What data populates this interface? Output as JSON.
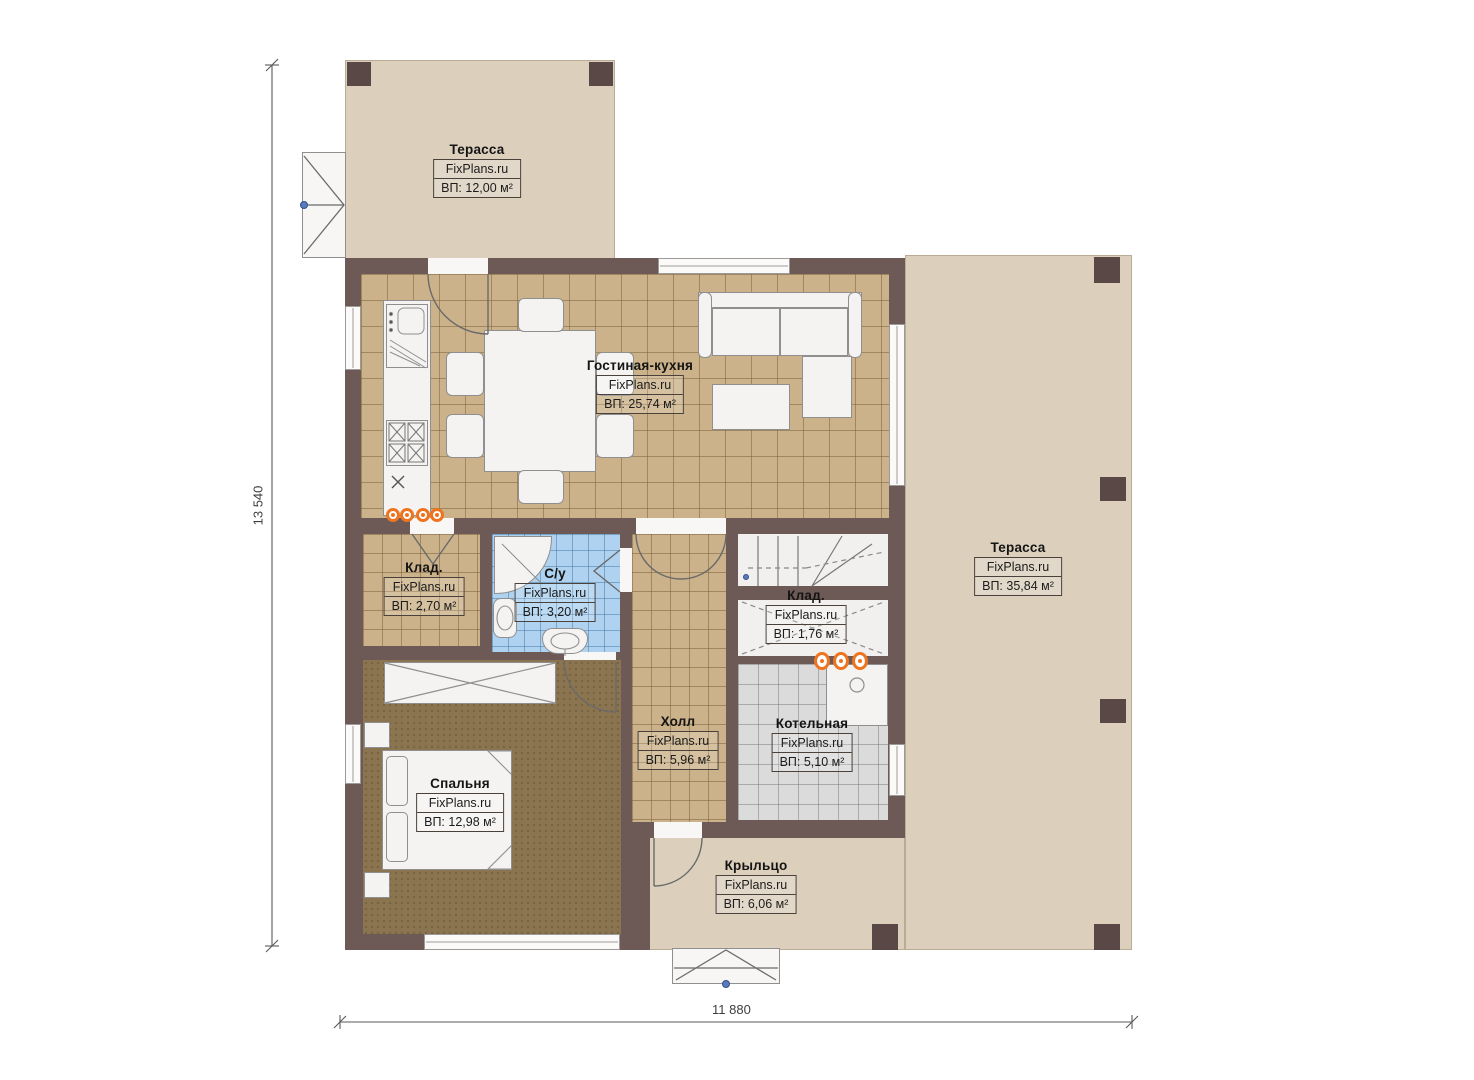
{
  "brand": "FixPlans.ru",
  "dimensions": {
    "left": "13 540",
    "bottom": "11 880"
  },
  "rooms": {
    "terrace_top": {
      "name": "Терасса",
      "area": "ВП: 12,00 м²"
    },
    "living_kitchen": {
      "name": "Гостиная-кухня",
      "area": "ВП: 25,74 м²"
    },
    "terrace_right": {
      "name": "Терасса",
      "area": "ВП: 35,84 м²"
    },
    "storage_left": {
      "name": "Клад.",
      "area": "ВП: 2,70 м²"
    },
    "bathroom": {
      "name": "С/у",
      "area": "ВП: 3,20 м²"
    },
    "storage_under_stairs": {
      "name": "Клад.",
      "area": "ВП: 1,76 м²"
    },
    "hall": {
      "name": "Холл",
      "area": "ВП: 5,96 м²"
    },
    "boiler_room": {
      "name": "Котельная",
      "area": "ВП: 5,10 м²"
    },
    "bedroom": {
      "name": "Спальня",
      "area": "ВП: 12,98 м²"
    },
    "porch": {
      "name": "Крыльцо",
      "area": "ВП: 6,06 м²"
    }
  },
  "colors": {
    "wall": "#6d5a57",
    "terrace": "#dcd0bd",
    "tile_floor": "#ccb28b",
    "bedroom_floor": "#8b7450",
    "bathroom_tile": "#aed2f0",
    "boiler_tile": "#dbdbdb",
    "radiator_orange": "#ee7420",
    "marker_blue": "#5b79bb"
  }
}
